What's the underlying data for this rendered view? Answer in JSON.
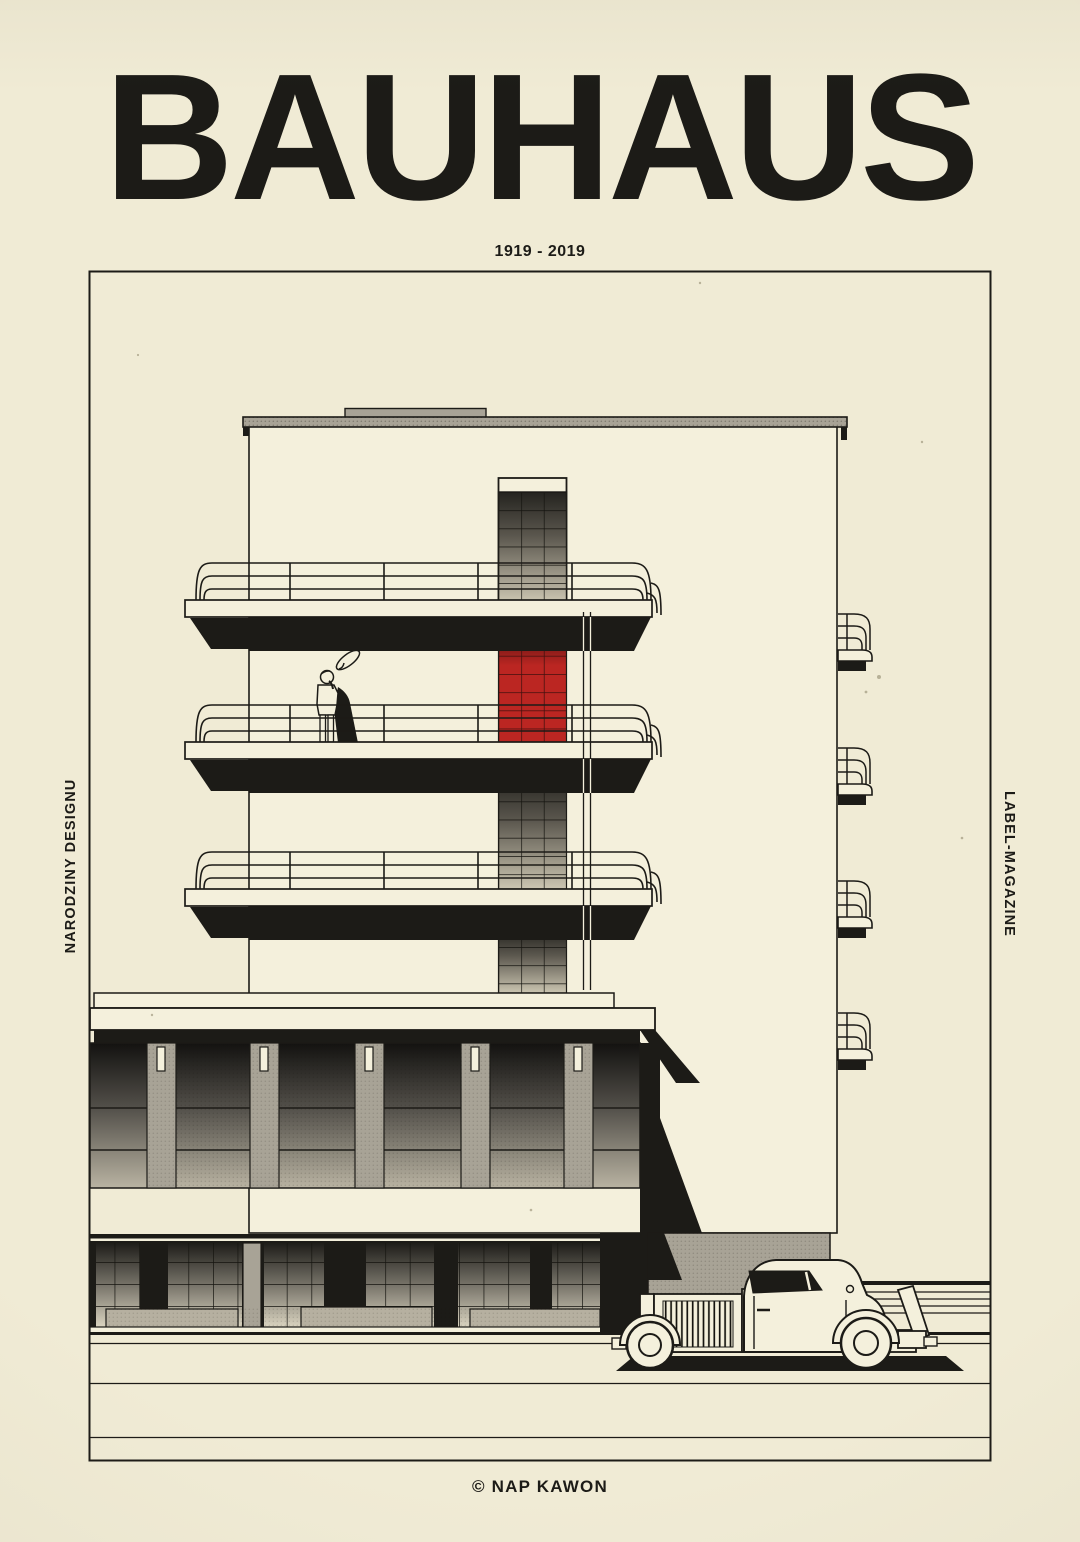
{
  "poster": {
    "title": "BAUHAUS",
    "subtitle": "1919 - 2019",
    "left_margin_label": "NARODZINY DESIGNU",
    "right_margin_label": "LABEL-MAGAZINE",
    "credit": "© NAP KAWON"
  },
  "colors": {
    "paper": "#f0ebd5",
    "building_face": "#f4f0dc",
    "ink": "#1c1b17",
    "accent_red": "#bb2622",
    "concrete_gray": "#a8a396"
  }
}
